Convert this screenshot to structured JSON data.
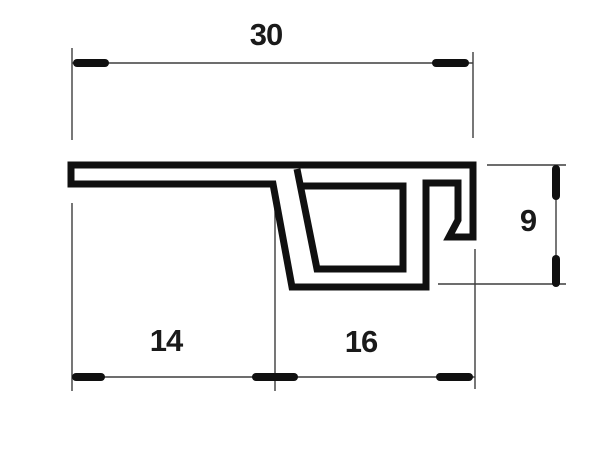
{
  "drawing": {
    "type": "technical-cross-section",
    "background_color": "#ffffff",
    "outline_color": "#101010",
    "thin_line_color": "#3d3d3d",
    "text_color": "#1a1a1a",
    "dimensions": {
      "d30": {
        "label": "30",
        "x": 266,
        "y": 35
      },
      "d14": {
        "label": "14",
        "x": 166,
        "y": 341
      },
      "d16": {
        "label": "16",
        "x": 361,
        "y": 342
      },
      "d9": {
        "label": "9",
        "x": 528,
        "y": 221
      }
    },
    "profile": {
      "stroke_width": 7,
      "outline_closed": true,
      "outline_points": [
        [
          71,
          165
        ],
        [
          473,
          165
        ],
        [
          473,
          237
        ],
        [
          449,
          237
        ],
        [
          458,
          220
        ],
        [
          458,
          183
        ],
        [
          426,
          183
        ],
        [
          426,
          287
        ],
        [
          292,
          287
        ],
        [
          273,
          184
        ],
        [
          71,
          184
        ]
      ],
      "cavity_points": [
        [
          297,
          169
        ],
        [
          317,
          269
        ],
        [
          403,
          269
        ],
        [
          403,
          186
        ],
        [
          300,
          186
        ]
      ]
    },
    "dimension_lines": {
      "thin_width": 1.4,
      "tick_width": 8,
      "extension_lines": [
        {
          "x1": 72,
          "y1": 48,
          "x2": 72,
          "y2": 140
        },
        {
          "x1": 473,
          "y1": 52,
          "x2": 473,
          "y2": 138
        },
        {
          "x1": 72,
          "y1": 203,
          "x2": 72,
          "y2": 391
        },
        {
          "x1": 275,
          "y1": 203,
          "x2": 275,
          "y2": 391
        },
        {
          "x1": 475,
          "y1": 249,
          "x2": 475,
          "y2": 389
        },
        {
          "x1": 487,
          "y1": 165,
          "x2": 566,
          "y2": 165
        },
        {
          "x1": 438,
          "y1": 284,
          "x2": 566,
          "y2": 284
        }
      ],
      "dimension_rules": [
        {
          "x1": 72,
          "y1": 63,
          "x2": 473,
          "y2": 63
        },
        {
          "x1": 72,
          "y1": 377,
          "x2": 475,
          "y2": 377
        },
        {
          "x1": 556,
          "y1": 165,
          "x2": 556,
          "y2": 284
        }
      ],
      "arrow_ticks": [
        {
          "x1": 77,
          "y1": 63,
          "x2": 105,
          "y2": 63
        },
        {
          "x1": 436,
          "y1": 63,
          "x2": 465,
          "y2": 63
        },
        {
          "x1": 76,
          "y1": 377,
          "x2": 101,
          "y2": 377
        },
        {
          "x1": 256,
          "y1": 377,
          "x2": 294,
          "y2": 377
        },
        {
          "x1": 440,
          "y1": 377,
          "x2": 469,
          "y2": 377
        },
        {
          "x1": 556,
          "y1": 169,
          "x2": 556,
          "y2": 196
        },
        {
          "x1": 556,
          "y1": 259,
          "x2": 556,
          "y2": 283
        }
      ]
    }
  }
}
